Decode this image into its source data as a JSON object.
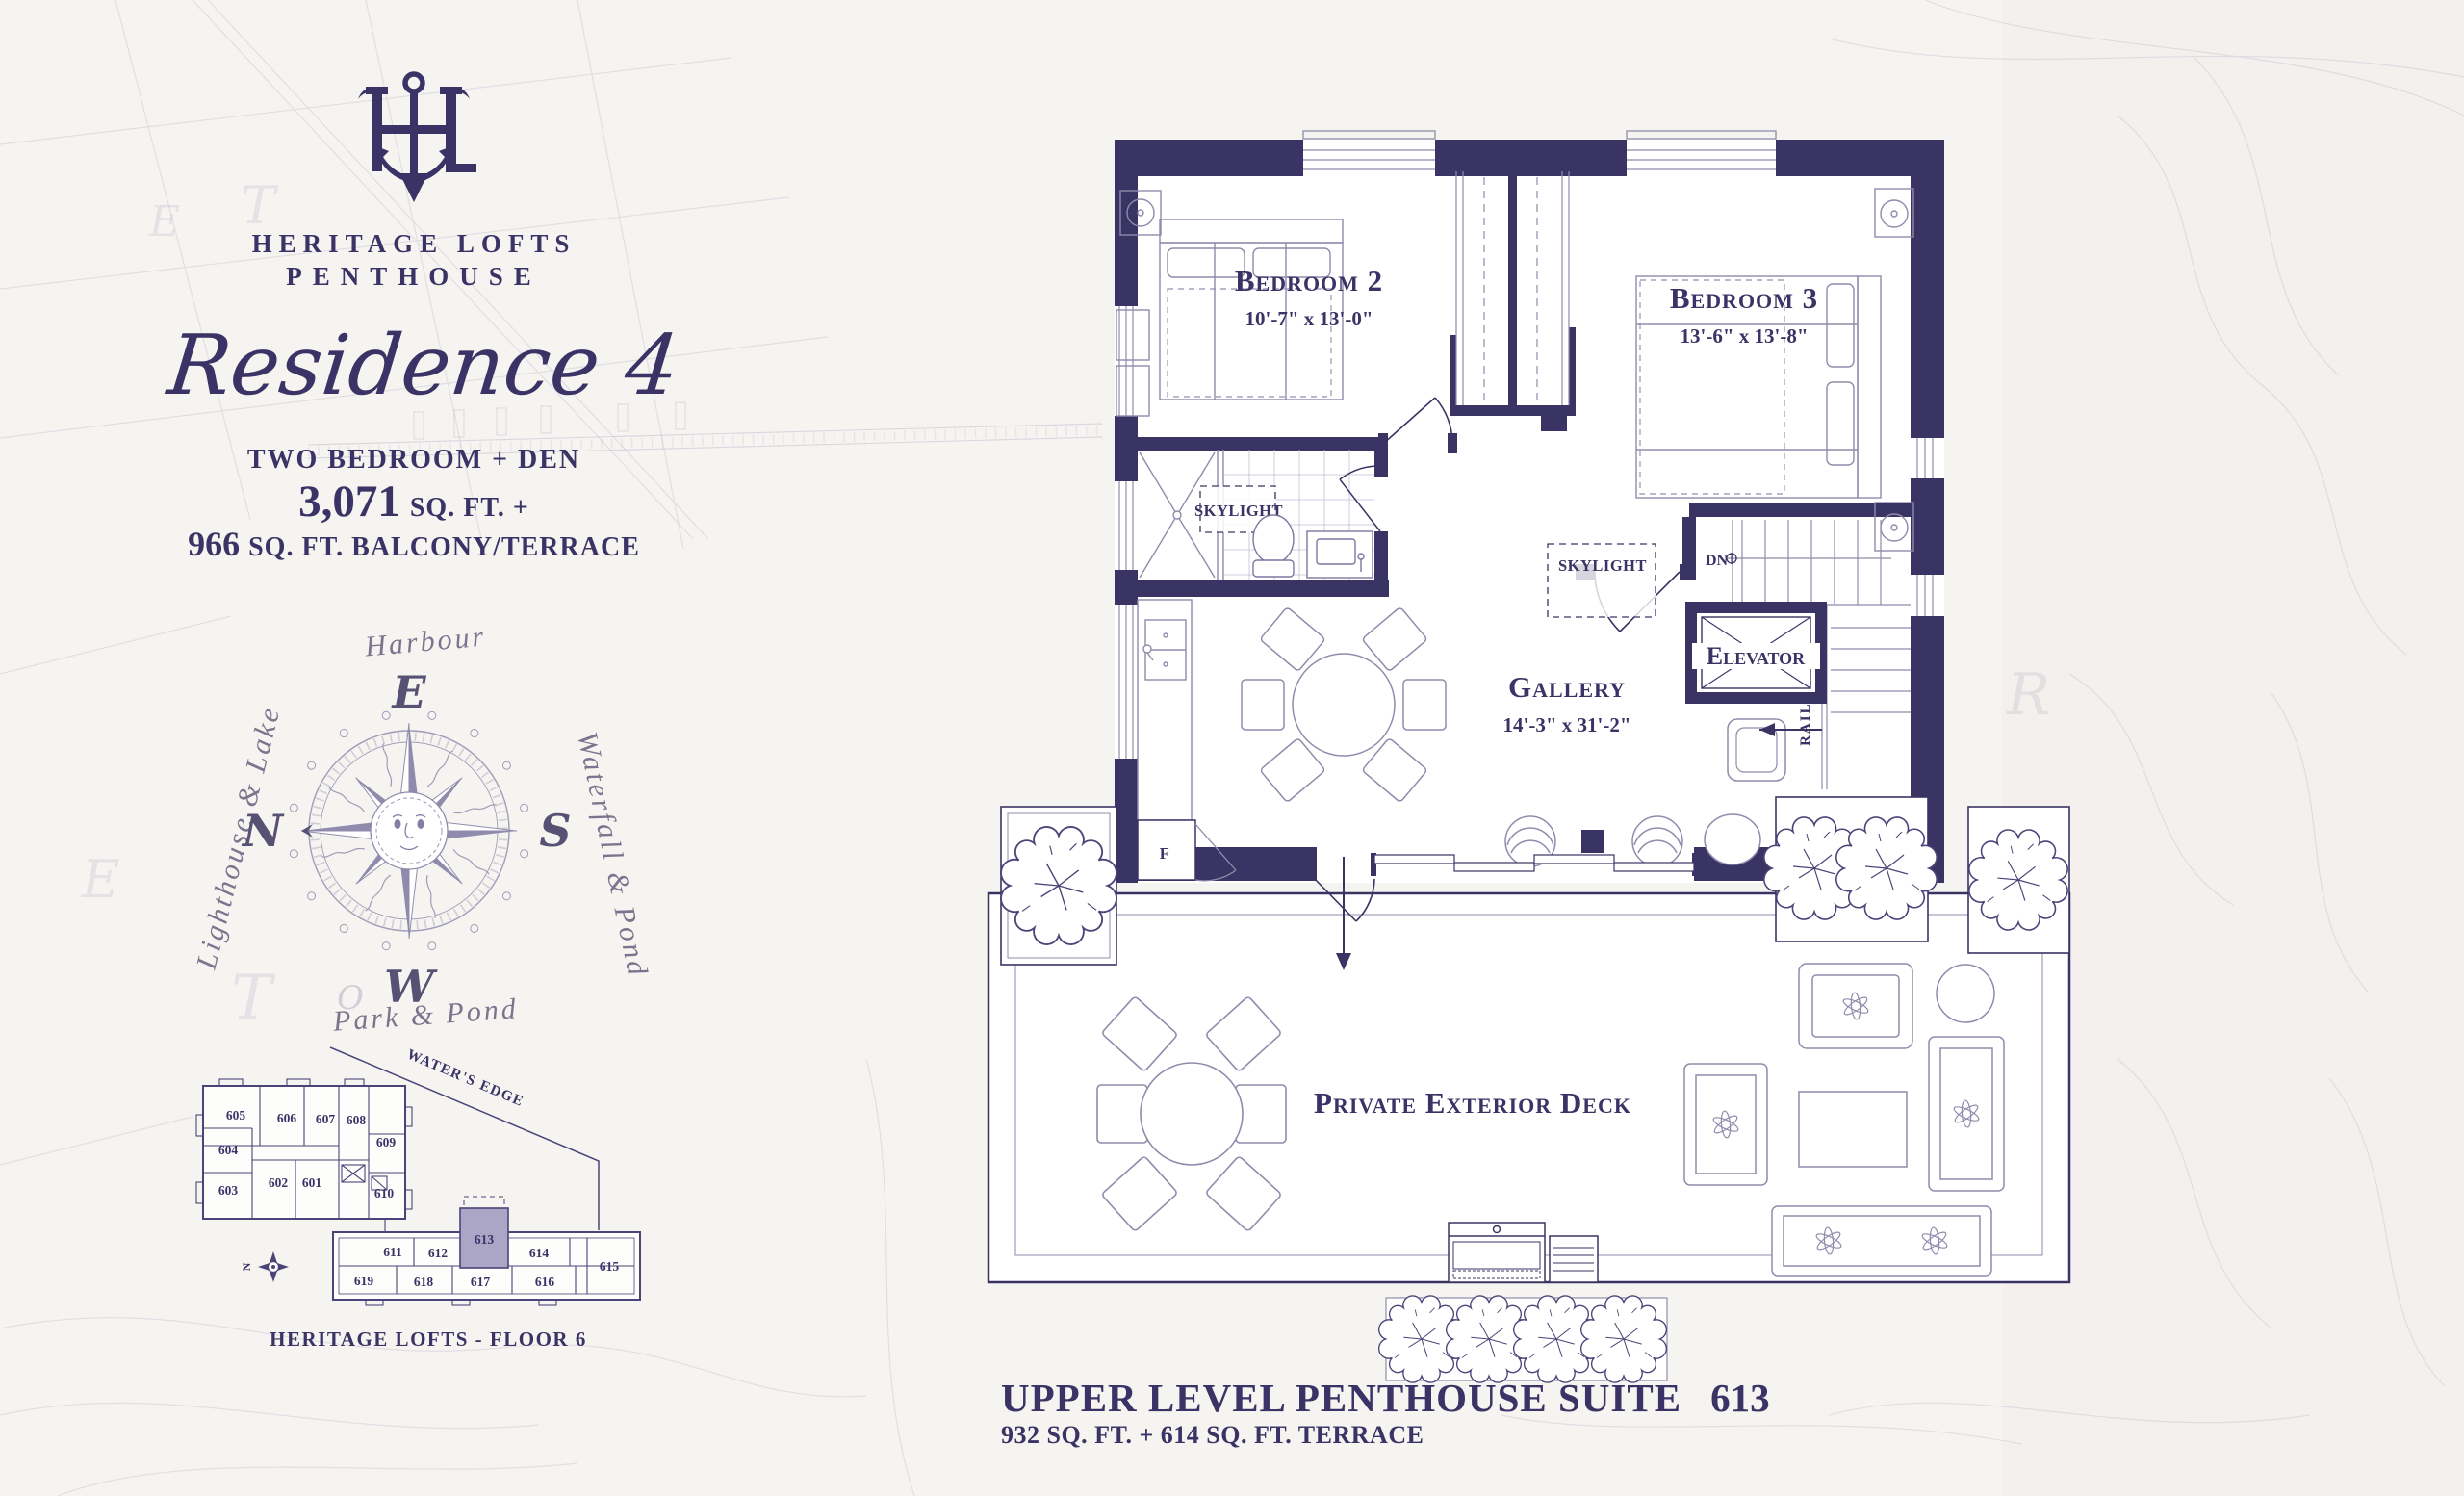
{
  "palette": {
    "ink": "#3b3366",
    "wall": "#3a3464",
    "line": "#8f8bac",
    "keyline": "#4b4478",
    "highlight": "#aba5c6",
    "paper": "#f6f4f1"
  },
  "brand": {
    "line1": "HERITAGE LOFTS",
    "line2": "PENTHOUSE"
  },
  "residence": {
    "script": "Residence 4",
    "type": "TWO BEDROOM + DEN",
    "area": "3,071",
    "area_suffix": "SQ. FT. +",
    "balcony": "966",
    "balcony_suffix": "SQ. FT. BALCONY/TERRACE"
  },
  "compass": {
    "top": "Harbour",
    "left": "Lighthouse & Lake",
    "right": "Waterfall & Pond",
    "bottom": "Park & Pond",
    "e": "E",
    "s": "S",
    "w": "W",
    "n": "N"
  },
  "keyplan": {
    "street": "WATER'S EDGE",
    "caption": "HERITAGE LOFTS - FLOOR 6",
    "north": "N",
    "highlighted": "613",
    "units": [
      "605",
      "606",
      "607",
      "608",
      "609",
      "604",
      "603",
      "602",
      "601",
      "610",
      "611",
      "612",
      "613",
      "614",
      "615",
      "619",
      "618",
      "617",
      "616"
    ]
  },
  "plan": {
    "bedroom2": {
      "name": "Bedroom 2",
      "dims": "10'-7\" x 13'-0\""
    },
    "bedroom3": {
      "name": "Bedroom 3",
      "dims": "13'-6\" x 13'-8\""
    },
    "gallery": {
      "name": "Gallery",
      "dims": "14'-3\" x 31'-2\""
    },
    "deck": {
      "name": "Private Exterior Deck"
    },
    "elevator": "Elevator",
    "skylight": "SKYLIGHT",
    "down": "DN",
    "railing": "RAILING",
    "fridge": "F"
  },
  "footer": {
    "title": "UPPER LEVEL PENTHOUSE SUITE",
    "suite": "613",
    "subtitle": "932 SQ. FT. + 614 SQ. FT. TERRACE"
  },
  "background": {
    "letters": [
      "T",
      "E",
      "T",
      "E",
      "R",
      "O"
    ]
  }
}
